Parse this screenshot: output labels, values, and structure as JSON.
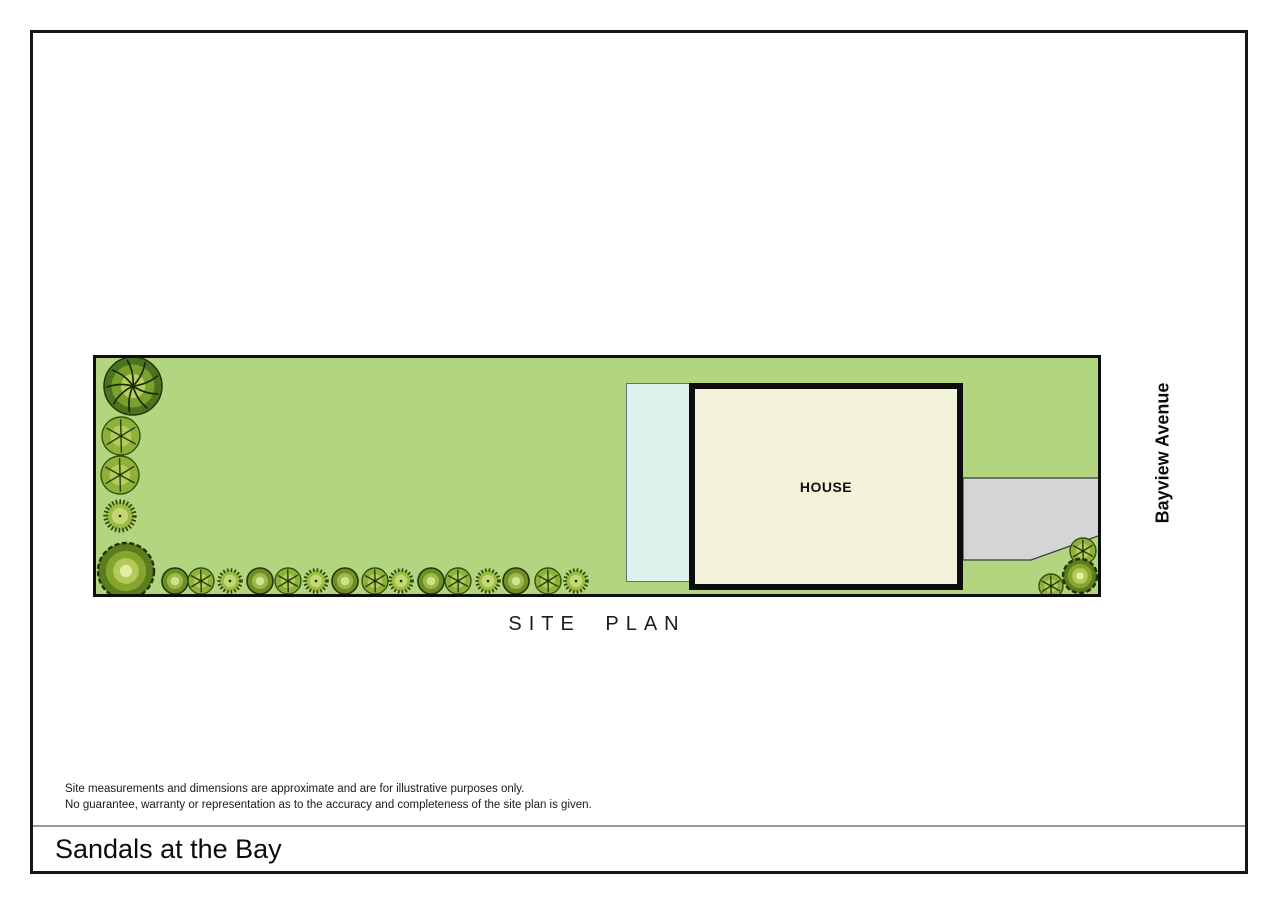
{
  "page": {
    "title": "Sandals at the Bay",
    "disclaimer": {
      "line1": "Site measurements and dimensions are approximate and are for illustrative purposes only.",
      "line2": "No guarantee, warranty or representation as to the accuracy and completeness of the site plan is given."
    }
  },
  "site_plan": {
    "caption": "SITE PLAN",
    "street_label": "Bayview Avenue",
    "house_label": "HOUSE",
    "colors": {
      "lawn": "#b4d57f",
      "plan_border": "#0e0e0e",
      "house_fill": "#f3f3dc",
      "house_border": "#0d0d0d",
      "pool_fill": "#ddf0ec",
      "pool_border": "#5f7370",
      "driveway_fill": "#d5d5d5",
      "driveway_border": "#3a3a3a",
      "tree_dark": "#4d7220",
      "tree_mid": "#8fb13a",
      "tree_light": "#d2e28c"
    },
    "driveway_points": "870,123 1008,123 1008,180 938,205 870,205",
    "trees": [
      {
        "type": "canopy-large",
        "x": 40,
        "y": 31,
        "r": 29
      },
      {
        "type": "star",
        "x": 28,
        "y": 81,
        "r": 19
      },
      {
        "type": "star",
        "x": 27,
        "y": 120,
        "r": 19
      },
      {
        "type": "spiky",
        "x": 27,
        "y": 161,
        "r": 17
      },
      {
        "type": "bush-large",
        "x": 33,
        "y": 216,
        "r": 28
      },
      {
        "type": "blob",
        "x": 82,
        "y": 226,
        "r": 13
      },
      {
        "type": "star",
        "x": 108,
        "y": 226,
        "r": 13
      },
      {
        "type": "spiky",
        "x": 137,
        "y": 226,
        "r": 13
      },
      {
        "type": "blob",
        "x": 167,
        "y": 226,
        "r": 13
      },
      {
        "type": "star",
        "x": 195,
        "y": 226,
        "r": 13
      },
      {
        "type": "spiky",
        "x": 223,
        "y": 226,
        "r": 13
      },
      {
        "type": "blob",
        "x": 252,
        "y": 226,
        "r": 13
      },
      {
        "type": "star",
        "x": 282,
        "y": 226,
        "r": 13
      },
      {
        "type": "spiky",
        "x": 308,
        "y": 226,
        "r": 13
      },
      {
        "type": "blob",
        "x": 338,
        "y": 226,
        "r": 13
      },
      {
        "type": "star",
        "x": 365,
        "y": 226,
        "r": 13
      },
      {
        "type": "spiky",
        "x": 395,
        "y": 226,
        "r": 13
      },
      {
        "type": "blob",
        "x": 423,
        "y": 226,
        "r": 13
      },
      {
        "type": "star",
        "x": 455,
        "y": 226,
        "r": 13
      },
      {
        "type": "spiky",
        "x": 483,
        "y": 226,
        "r": 13
      },
      {
        "type": "star",
        "x": 990,
        "y": 196,
        "r": 13
      },
      {
        "type": "bush-large",
        "x": 987,
        "y": 221,
        "r": 17
      },
      {
        "type": "star",
        "x": 958,
        "y": 231,
        "r": 12
      }
    ]
  }
}
